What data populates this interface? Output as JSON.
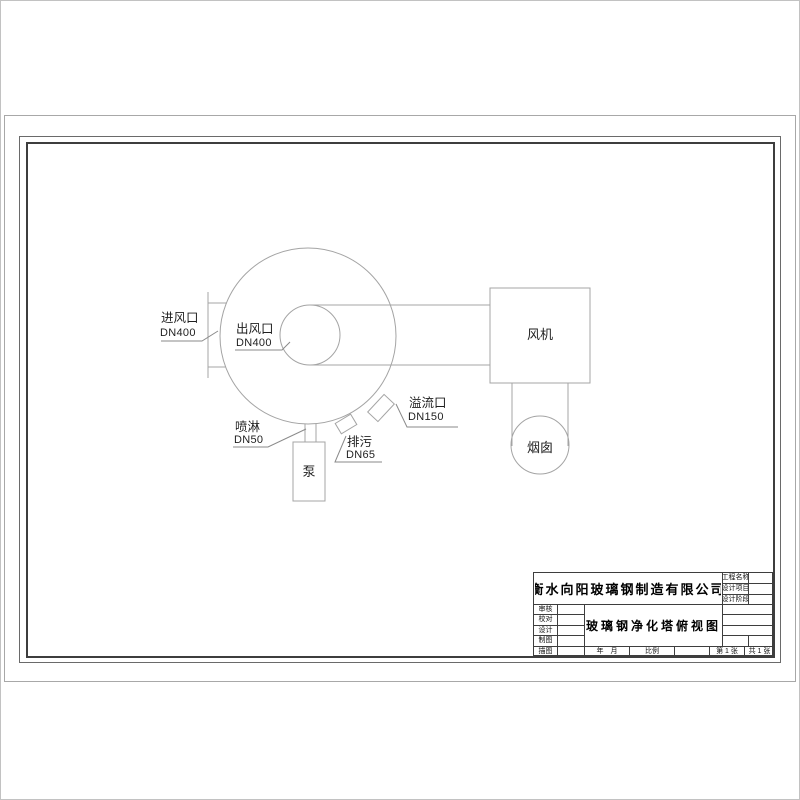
{
  "drawing": {
    "labels": {
      "inlet": {
        "name": "进风口",
        "size": "DN400"
      },
      "outlet": {
        "name": "出风口",
        "size": "DN400"
      },
      "spray": {
        "name": "喷淋",
        "size": "DN50"
      },
      "drain": {
        "name": "排污",
        "size": "DN65"
      },
      "overflow": {
        "name": "溢流口",
        "size": "DN150"
      },
      "pump": "泵",
      "fan": "风机",
      "chimney": "烟囱"
    },
    "line_color": "#a4a4a4",
    "leader_color": "#8a8a8a",
    "text_color": "#1f1f1f"
  },
  "title_block": {
    "company": "衡水向阳玻璃钢制造有限公司",
    "drawing_title": "玻璃钢净化塔俯视图",
    "left_labels": [
      "审核",
      "校对",
      "设计",
      "制图",
      "描图"
    ],
    "right_labels": [
      "工程名称",
      "设计项目",
      "设计阶段"
    ],
    "date_label": "年　月",
    "scale_label": "比例",
    "sheet_label": "第 1 张",
    "total_label": "共 1 张"
  }
}
